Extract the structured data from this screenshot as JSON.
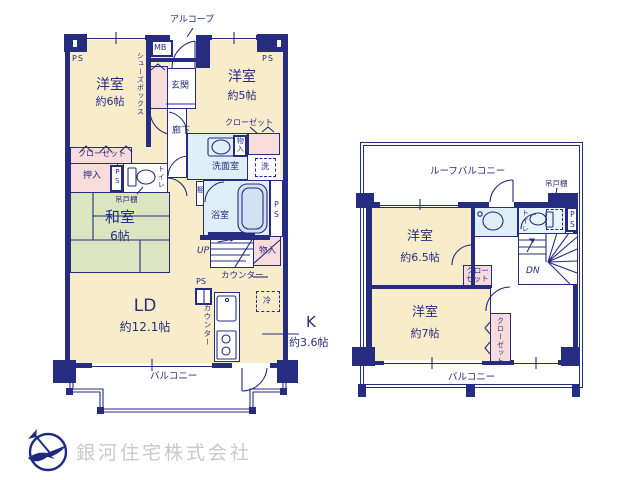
{
  "company": {
    "name": "銀河住宅株式会社"
  },
  "colors": {
    "wall_navy": "#262c80",
    "room_cream": "#f8ecca",
    "tatami_green": "#dbe5c1",
    "closet_pink": "#f8dcdc",
    "water_blue": "#dfeef7",
    "logo_text_gray": "#c9c9c9"
  },
  "shared": {
    "ps": "PS",
    "closet": "クローゼット",
    "storage": "物入",
    "counter": "カウンター",
    "balcony": "バルコニー",
    "hanging_cupboard": "吊戸棚",
    "toilet": "トイレ"
  },
  "unit1": {
    "alcove": "アルコーブ",
    "mb": "MB",
    "shoe_box": "シューズボックス",
    "entrance": "玄関",
    "corridor": "廊下",
    "room_west_6": {
      "name": "洋室",
      "size": "約6帖"
    },
    "room_west_5": {
      "name": "洋室",
      "size": "約5帖"
    },
    "washroom": "洗面室",
    "laundry": "洗",
    "oshiire": "押入",
    "shelf": "棚",
    "bath": "浴室",
    "japanese_room": {
      "name": "和室",
      "size": "6帖"
    },
    "up": "UP",
    "living_dining": {
      "name": "LD",
      "size": "約12.1帖"
    },
    "kitchen": {
      "name": "K",
      "size": "約3.6帖"
    },
    "fridge": "冷"
  },
  "unit2": {
    "roof_balcony": "ルーフバルコニー",
    "room_west_65": {
      "name": "洋室",
      "size": "約6.5帖"
    },
    "room_west_7": {
      "name": "洋室",
      "size": "約7帖"
    },
    "closet_two_line": "クロー\nゼット",
    "dn": "DN"
  }
}
